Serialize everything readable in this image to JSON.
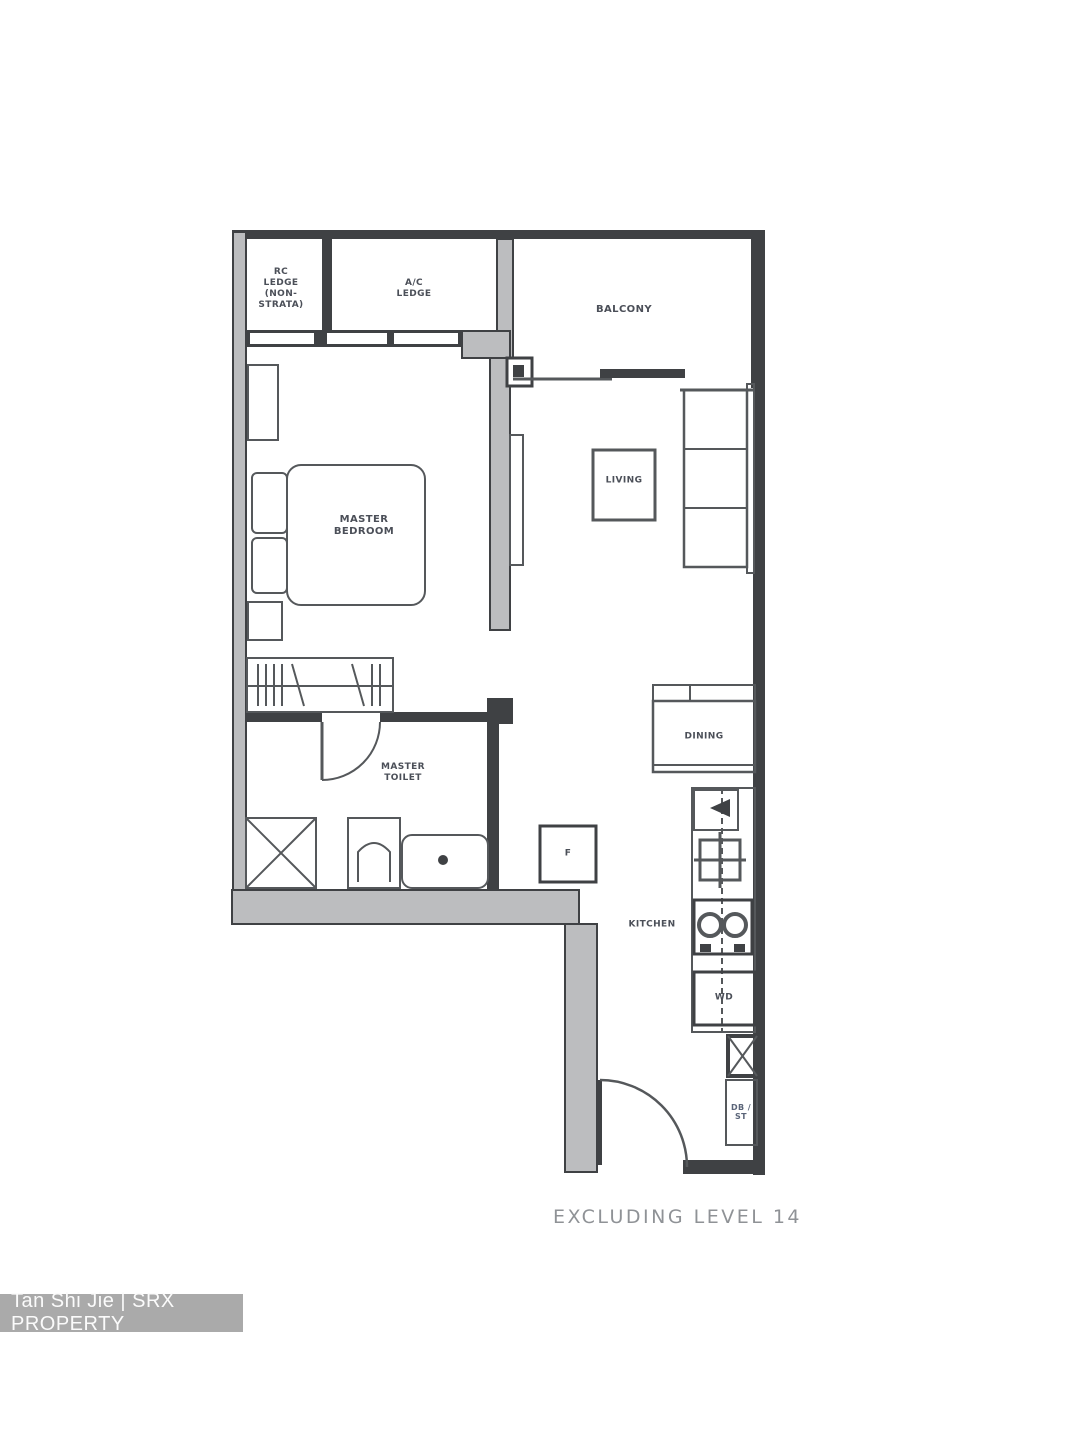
{
  "canvas": {
    "width": 1080,
    "height": 1440
  },
  "rooms": {
    "rc_ledge": {
      "lines": [
        "RC",
        "LEDGE",
        "(NON-",
        "STRATA)"
      ]
    },
    "ac_ledge": {
      "lines": [
        "A/C",
        "LEDGE"
      ]
    },
    "balcony": {
      "lines": [
        "BALCONY"
      ]
    },
    "master_bedroom": {
      "lines": [
        "MASTER",
        "BEDROOM"
      ]
    },
    "living": {
      "lines": [
        "LIVING"
      ]
    },
    "dining": {
      "lines": [
        "DINING"
      ]
    },
    "master_toilet": {
      "lines": [
        "MASTER",
        "TOILET"
      ]
    },
    "kitchen": {
      "lines": [
        "KITCHEN"
      ]
    }
  },
  "fixtures": {
    "fridge_label": "F",
    "washer_dryer_label": "WD",
    "db_store": {
      "lines": [
        "DB /",
        "ST"
      ]
    }
  },
  "caption": "EXCLUDING LEVEL 14",
  "watermark": "Tan Shi Jie | SRX PROPERTY",
  "colors": {
    "wall_dark": "#3f4144",
    "wall_gray": "#bcbdbf",
    "furniture_stroke": "#55585b",
    "label_text": "#4b4f58",
    "caption_text": "#8f9296",
    "watermark_bg": "#aaaaaa",
    "watermark_text": "#fbfbfb"
  }
}
